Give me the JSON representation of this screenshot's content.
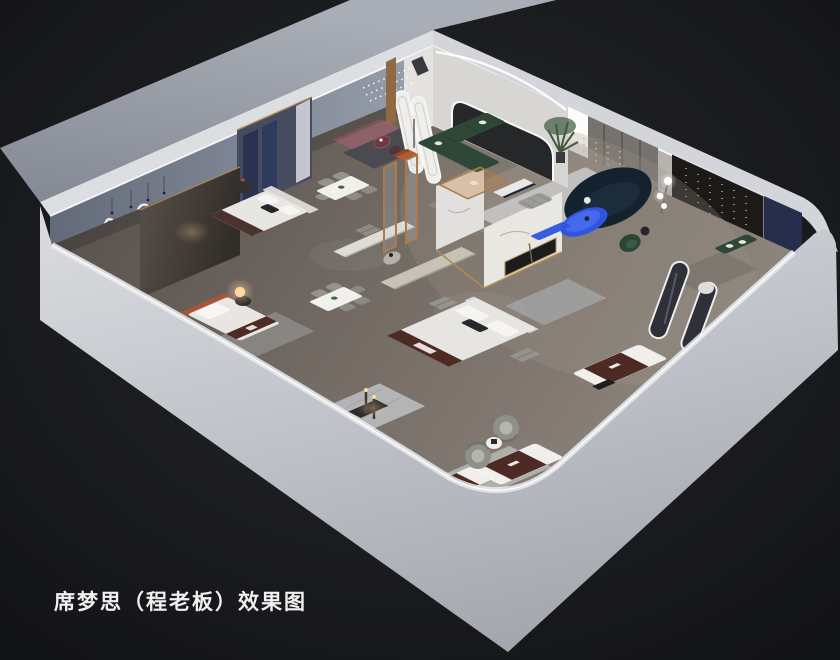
{
  "scene": {
    "caption": "席梦思（程老板）效果图",
    "palette": {
      "background": "#17181b",
      "exterior_wall": "#c3c6cb",
      "interior_wall_blue": "#7e8595",
      "floor_wood": "#6e6660",
      "marble_white": "#e9e7e2",
      "wood_trim": "#a87c4f",
      "led_white": "#f6f7f5",
      "accent_blue": "#2f55e0",
      "sofa_green": "#2f4737",
      "sofa_navy": "#14212e",
      "mattress_brown": "#4e2a24",
      "bench_mauve": "#8e6169",
      "lamp_warm": "#ffd9a0"
    }
  }
}
